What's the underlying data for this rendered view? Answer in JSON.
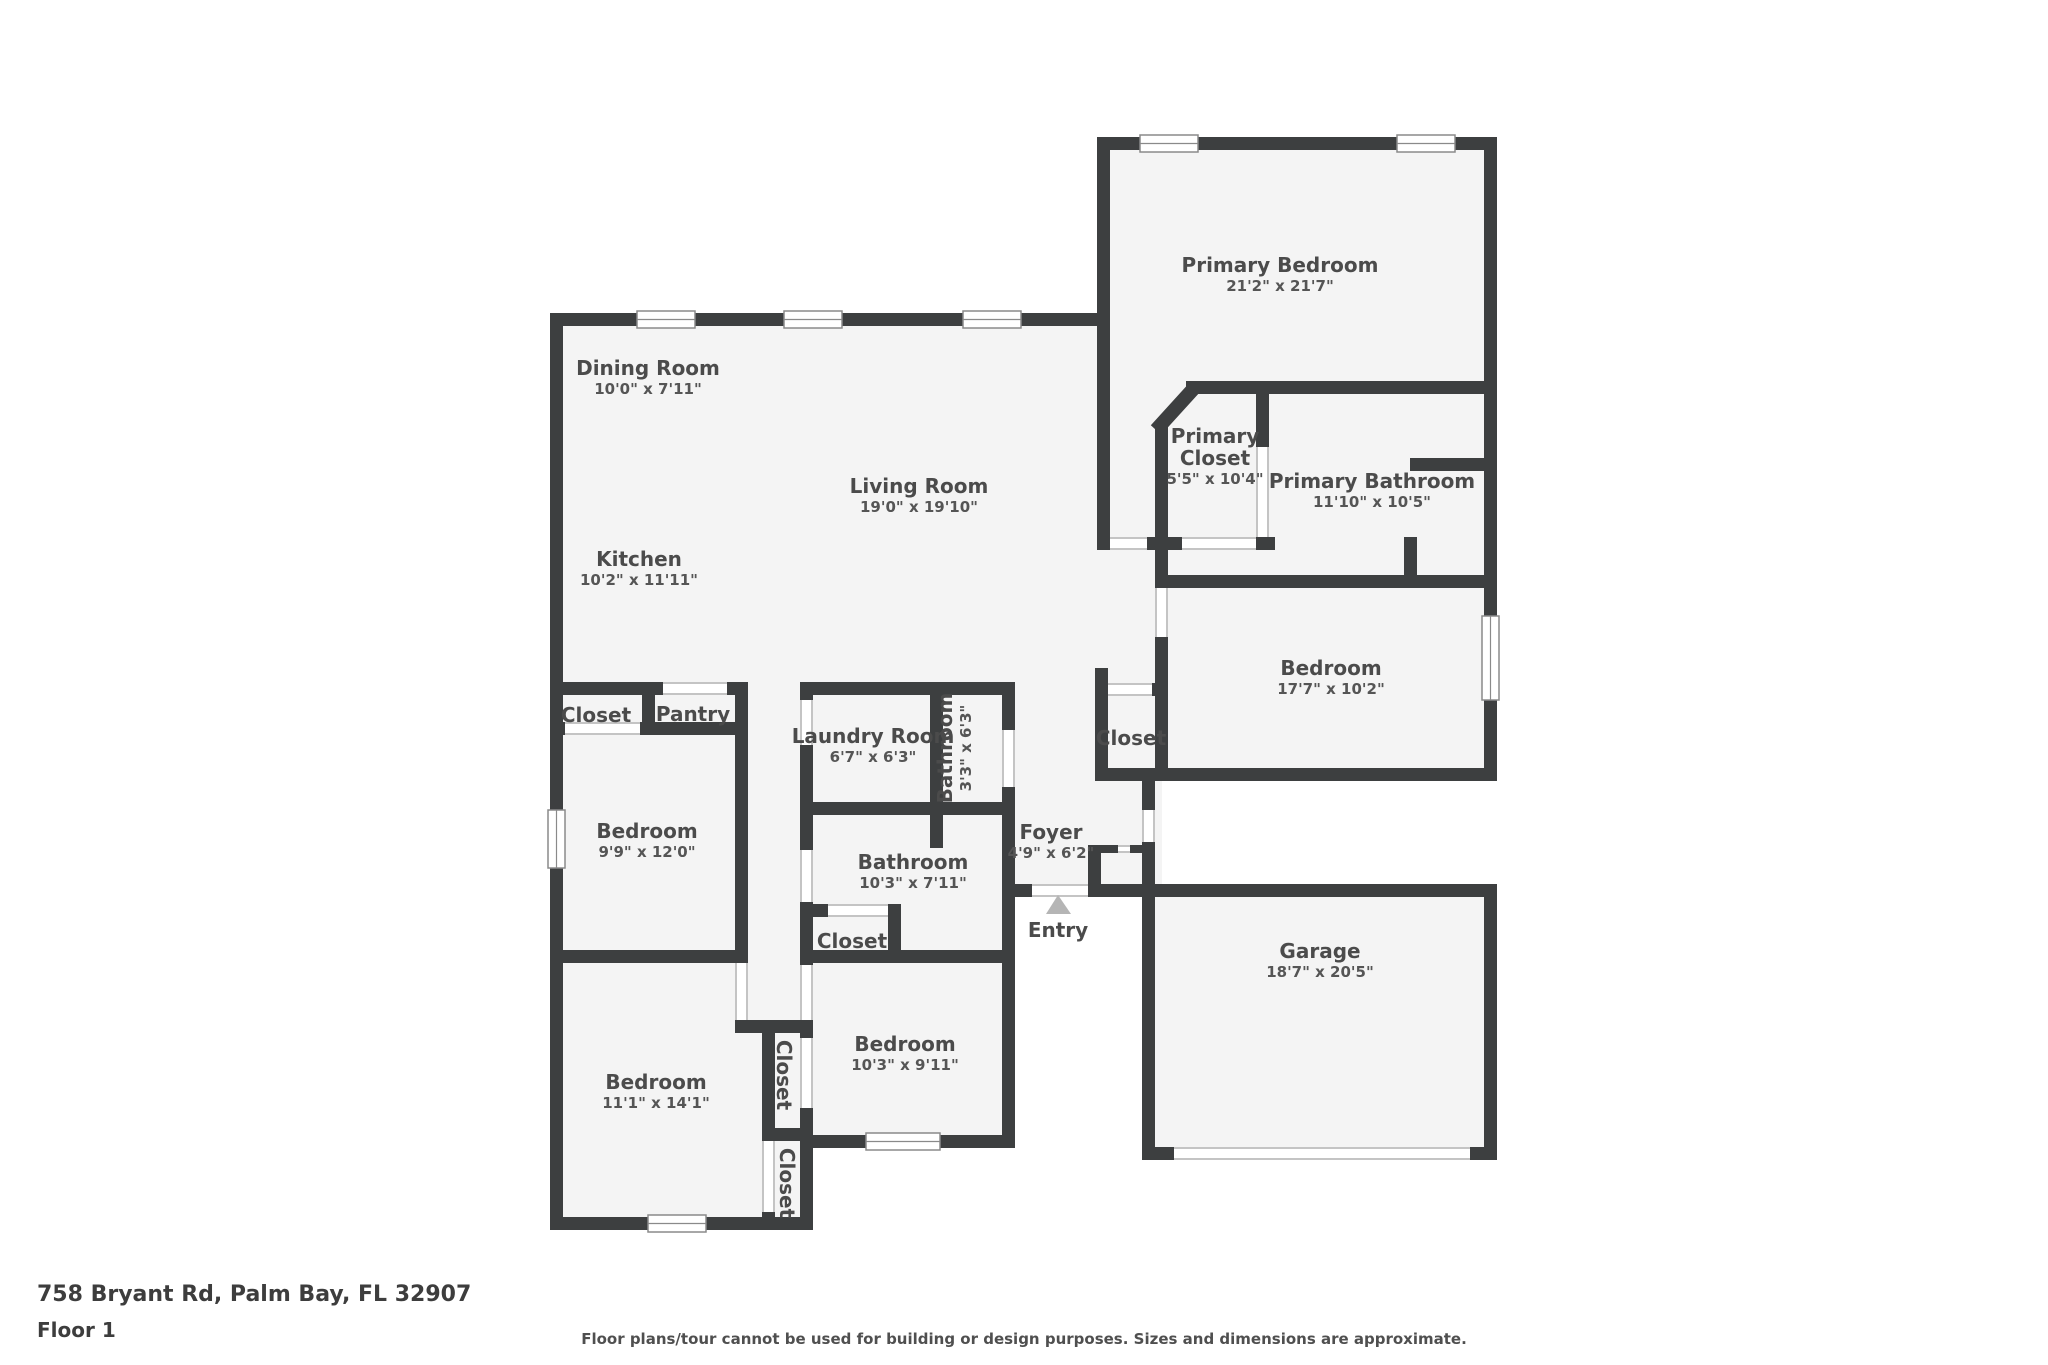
{
  "footer": {
    "address": "758 Bryant Rd, Palm Bay, FL 32907",
    "floor_label": "Floor 1",
    "disclaimer": "Floor plans/tour cannot be used for building or design purposes. Sizes and dimensions are approximate."
  },
  "colors": {
    "wall": "#3d3f40",
    "room_fill": "#f4f4f4",
    "outside": "#ffffff",
    "label_text": "#4b4b4b",
    "window_frame": "#8a8a8a",
    "opening_line": "#c4c4c4",
    "entry_arrow": "#b5b5b5"
  },
  "entry": {
    "label": "Entry",
    "x": 1058,
    "y": 937
  },
  "rooms": [
    {
      "id": "primary-bedroom",
      "name": "Primary Bedroom",
      "dims": "21'2\" x 21'7\"",
      "x": 1280,
      "y": 278,
      "rot": 0
    },
    {
      "id": "dining-room",
      "name": "Dining Room",
      "dims": "10'0\" x 7'11\"",
      "x": 648,
      "y": 381,
      "rot": 0
    },
    {
      "id": "living-room",
      "name": "Living Room",
      "dims": "19'0\" x 19'10\"",
      "x": 919,
      "y": 499,
      "rot": 0
    },
    {
      "id": "kitchen",
      "name": "Kitchen",
      "dims": "10'2\" x 11'11\"",
      "x": 639,
      "y": 572,
      "rot": 0
    },
    {
      "id": "primary-closet",
      "name": "Primary\nCloset",
      "dims": "5'5\" x 10'4\"",
      "x": 1215,
      "y": 471,
      "rot": 0
    },
    {
      "id": "primary-bathroom",
      "name": "Primary Bathroom",
      "dims": "11'10\" x 10'5\"",
      "x": 1372,
      "y": 494,
      "rot": 0
    },
    {
      "id": "bedroom-right",
      "name": "Bedroom",
      "dims": "17'7\" x 10'2\"",
      "x": 1331,
      "y": 681,
      "rot": 0
    },
    {
      "id": "closet-hall",
      "name": "Closet",
      "dims": "",
      "x": 1131,
      "y": 738,
      "rot": 0
    },
    {
      "id": "laundry-room",
      "name": "Laundry Room",
      "dims": "6'7\" x 6'3\"",
      "x": 873,
      "y": 749,
      "rot": 0
    },
    {
      "id": "bathroom-small",
      "name": "Bathroom",
      "dims": "3'3\" x 6'3\"",
      "x": 958,
      "y": 748,
      "rot": -90
    },
    {
      "id": "foyer",
      "name": "Foyer",
      "dims": "4'9\" x 6'2\"",
      "x": 1051,
      "y": 845,
      "rot": 0
    },
    {
      "id": "closet-top-row",
      "name": "Closet",
      "dims": "",
      "x": 596,
      "y": 715,
      "rot": 0
    },
    {
      "id": "pantry",
      "name": "Pantry",
      "dims": "",
      "x": 693,
      "y": 714,
      "rot": 0
    },
    {
      "id": "bedroom-left-mid",
      "name": "Bedroom",
      "dims": "9'9\" x 12'0\"",
      "x": 647,
      "y": 844,
      "rot": 0
    },
    {
      "id": "bathroom-main",
      "name": "Bathroom",
      "dims": "10'3\" x 7'11\"",
      "x": 913,
      "y": 875,
      "rot": 0
    },
    {
      "id": "closet-bath",
      "name": "Closet",
      "dims": "",
      "x": 852,
      "y": 941,
      "rot": 0
    },
    {
      "id": "bedroom-center",
      "name": "Bedroom",
      "dims": "10'3\" x 9'11\"",
      "x": 905,
      "y": 1057,
      "rot": 0
    },
    {
      "id": "bedroom-left-bot",
      "name": "Bedroom",
      "dims": "11'1\" x 14'1\"",
      "x": 656,
      "y": 1095,
      "rot": 0
    },
    {
      "id": "closet-vert-top",
      "name": "Closet",
      "dims": "",
      "x": 784,
      "y": 1075,
      "rot": 90
    },
    {
      "id": "closet-vert-bot",
      "name": "Closet",
      "dims": "",
      "x": 787,
      "y": 1183,
      "rot": 90
    },
    {
      "id": "garage",
      "name": "Garage",
      "dims": "18'7\" x 20'5\"",
      "x": 1320,
      "y": 964,
      "rot": 0
    }
  ]
}
